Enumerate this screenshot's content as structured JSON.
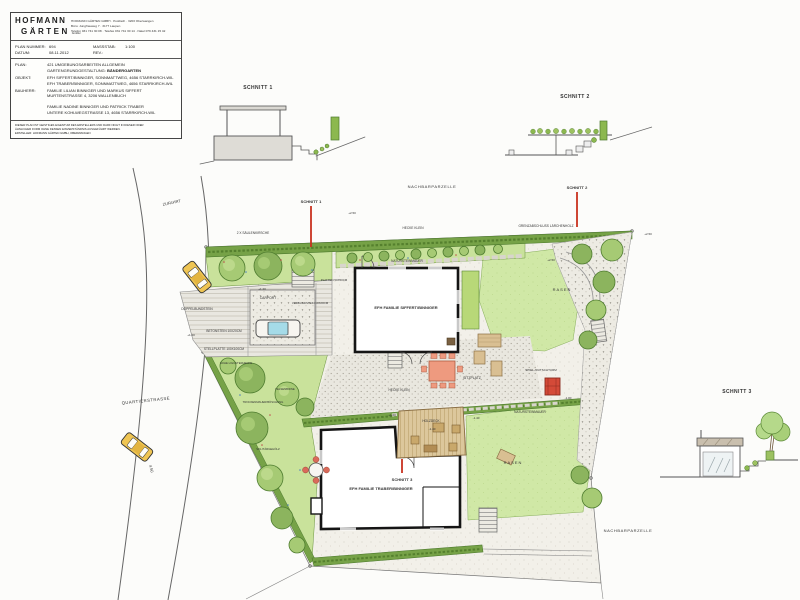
{
  "title_block": {
    "logo_line1": "HOFMANN",
    "logo_line2": "GÄRTEN",
    "logo_suffix": "GmbH",
    "address_lines": [
      "HOFMANN GÄRTEN GMBH · Postfach · 3203 Oberwangen",
      "Büro: Jungfrauweg 7 · 3177 Laupen",
      "Telefon 031 741 30 08 · Telefax 031 741 30 14 · Natel 079 431 15 42"
    ],
    "fields": {
      "plan_nummer_label": "PLAN NUMMER:",
      "plan_nummer": "694",
      "massstab_label": "MASSSTAB:",
      "massstab": "1:100",
      "datum_label": "DATUM:",
      "datum": "08.11.2012",
      "rev_label": "REV.:",
      "plan_label": "PLAN:",
      "plan_line1": "421 UMGEBUNGSARBEITEN ALLGEMEIN",
      "plan_line2_label": "GARTENGRUNDGESTALTUNG:",
      "plan_line2_value": "BÄNDERGARTEN",
      "objekt_label": "OBJEKT:",
      "objekt_line1": "EFH SIFFERT/BINNIGER, SONNMATTWEG, 4656 STARRKIRCH-WIL",
      "objekt_line2": "EFH TRABER/BINNIGER, SONNMATTWEG, 4656 STARRKIRCH-WIL",
      "bauherr_label": "BAUHERR:",
      "bauherr_line1": "FAMILIE LILIAN BINNIGER UND MARKUS SIFFERT",
      "bauherr_line2": "MURTENSTRASSE 4, 3206 WALLENBUCH",
      "bauherr_line3": "FAMILIE NADINE BINNIGER UND PATRICK TRABER",
      "bauherr_line4": "UNTERE KOHLWEGSTRASSE 13, 4656 STARRKIRCH-WIL"
    },
    "footer_lines": [
      "DIESER PLAN IST GEISTIGES EIGENTUM DES ERSTELLERS UND DARF NICHT IN DIESER ODER",
      "ÄHNLICHER FORM OHNE DESSEN EINVERSTÄNDNIS AUSGEFÜHRT WERDEN.",
      "ERSTELLER: HOFMANN GÄRTEN GMBH, OBERWANGEN"
    ]
  },
  "sections": {
    "schnitt1_title": "SCHNITT 1",
    "schnitt2_title": "SCHNITT 2",
    "schnitt3_title": "SCHNITT 3"
  },
  "plan_labels": {
    "zufahrt": "ZUFAHRT",
    "quartierstrasse": "QUARTIERSTRASSE",
    "dim_road": "4.50",
    "nachbar_top": "NACHBARPARZELLE",
    "nachbar_bottom": "NACHBARPARZELLE",
    "saeulenkirsche": "2 X SÄULENKIRSCHE",
    "hecke_klein_top": "HECKE KLEIN",
    "grenzabschluss": "GRENZABSCHLUSS LÄRCHENHOLZ",
    "naturstein_top": "NATURSTEINMAUER",
    "hecke_klein_mid": "HECKE KLEIN",
    "naturstein_mid": "NATURSTEINMAUER",
    "sitzplatz": "SITZPLATZ",
    "rasen_top": "RASEN",
    "rasen_bottom": "RASEN",
    "spielturm": "SPIEL-/RUTSCHTURM",
    "holzdeck": "HOLZDECK",
    "efh_siffert": "EFH FAMILIE SIFFERT/BINNIGER",
    "efh_traber": "EFH FAMILIE TRABER/BINNIGER",
    "carport": "CARPORT",
    "verbundstein": "VERBUNDSTEIN 10X20CM",
    "doppelbundstein": "DOPPELBUNDSTEIN",
    "betonstein": "BETONSTEIN 10X20CM",
    "stellplatte": "STELLPLATTE 100X100CM",
    "platten": "PLATTEN 50X50CM",
    "schnitt1": "SCHNITT 1",
    "schnitt2": "SCHNITT 2",
    "schnitt3": "SCHNITT 3",
    "liguster": "HOHE LIGUSTERHECKE",
    "trockenmauer": "TROCKENMAUER/BÖSCHUNG",
    "felsenbirne": "FELSENBIRNE",
    "solitaer": "SOLITÄRGEHÖLZ"
  },
  "elevations": [
    {
      "v": "+2.50"
    },
    {
      "v": "+2.50"
    },
    {
      "v": "+1.20"
    },
    {
      "v": "+1.20"
    },
    {
      "v": "-1.40"
    },
    {
      "v": "-1.00"
    },
    {
      "v": "+2.50"
    },
    {
      "v": "-1.40"
    },
    {
      "v": "+1.00"
    }
  ],
  "colors": {
    "section_red": "#c8311f",
    "hedge_green": "#76a247",
    "lawn_green": "#d0e8a6",
    "wood_tan": "#dcc79c",
    "car_yellow": "#efc553",
    "play_red": "#d44a38"
  }
}
